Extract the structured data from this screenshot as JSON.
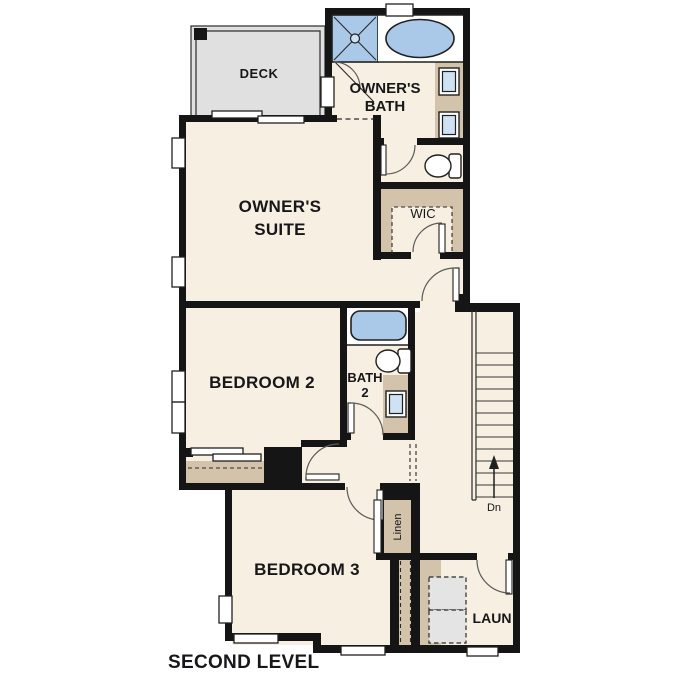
{
  "title": "SECOND LEVEL",
  "colors": {
    "background": "#ffffff",
    "wall": "#151515",
    "floor": "#f7efe2",
    "casework_tan": "#d2c3aa",
    "fixture_blue": "#aac9e8",
    "deck_gray": "#e0e0e0",
    "appliance_gray": "#e4e4e4",
    "text": "#17171a"
  },
  "rooms": {
    "deck": {
      "label": "DECK"
    },
    "owners_bath": {
      "label_line1": "OWNER'S",
      "label_line2": "BATH"
    },
    "owners_suite": {
      "label_line1": "OWNER'S",
      "label_line2": "SUITE"
    },
    "wic": {
      "label": "WIC"
    },
    "bedroom2": {
      "label": "BEDROOM 2"
    },
    "bath2": {
      "label_line1": "BATH",
      "label_line2": "2"
    },
    "linen": {
      "label": "Linen"
    },
    "bedroom3": {
      "label": "BEDROOM 3"
    },
    "laundry": {
      "label": "LAUN"
    }
  },
  "stairs": {
    "direction_label": "Dn"
  },
  "fixtures": {
    "shower": "corner shower with glass door",
    "owners_tub": "oval soaking tub",
    "owners_vanity_sinks": 2,
    "toilets": 2,
    "bath2_tub": "tub",
    "bath2_vanity_sinks": 1,
    "washer_dryer": "stacked washer/dryer"
  }
}
